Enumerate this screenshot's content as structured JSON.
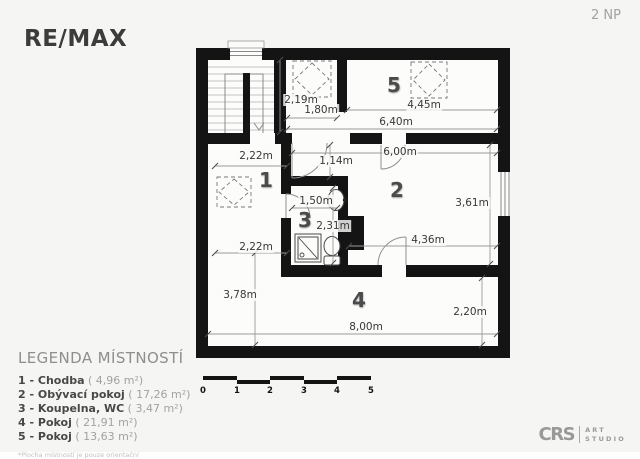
{
  "header": {
    "brand": "RE/MAX",
    "floor_label": "2 NP"
  },
  "legend": {
    "title": "LEGENDA MÍSTNOSTÍ",
    "items": [
      {
        "name": "1 - Chodba",
        "area": "( 4,96 m²)"
      },
      {
        "name": "2 - Obývací pokoj",
        "area": "( 17,26 m²)"
      },
      {
        "name": "3 - Koupelna, WC",
        "area": "( 3,47 m²)"
      },
      {
        "name": "4 - Pokoj",
        "area": "( 21,91 m²)"
      },
      {
        "name": "5 - Pokoj",
        "area": "( 13,63 m²)"
      }
    ],
    "footnote": "*Plocha místností je pouze orientační"
  },
  "floorplan": {
    "rooms": [
      {
        "number": "1"
      },
      {
        "number": "2"
      },
      {
        "number": "3"
      },
      {
        "number": "4"
      },
      {
        "number": "5"
      }
    ],
    "dimensions": [
      {
        "text": "2,19m"
      },
      {
        "text": "1,80m"
      },
      {
        "text": "4,45m"
      },
      {
        "text": "6,40m"
      },
      {
        "text": "2,22m"
      },
      {
        "text": "1,14m"
      },
      {
        "text": "6,00m"
      },
      {
        "text": "3,61m"
      },
      {
        "text": "1,50m"
      },
      {
        "text": "2,31m"
      },
      {
        "text": "4,36m"
      },
      {
        "text": "2,22m"
      },
      {
        "text": "3,78m"
      },
      {
        "text": "8,00m"
      },
      {
        "text": "2,20m"
      }
    ]
  },
  "scale_bar": {
    "labels": [
      "0",
      "1",
      "2",
      "3",
      "4",
      "5"
    ]
  },
  "studio": {
    "monogram": "CRS",
    "line1": "ART",
    "line2": "STUDIO"
  },
  "colors": {
    "wall": "#141414",
    "background": "#f5f5f3",
    "floor": "#fcfcfb",
    "brand_text": "#3c3c3c",
    "muted_text": "#9b9b9b"
  }
}
